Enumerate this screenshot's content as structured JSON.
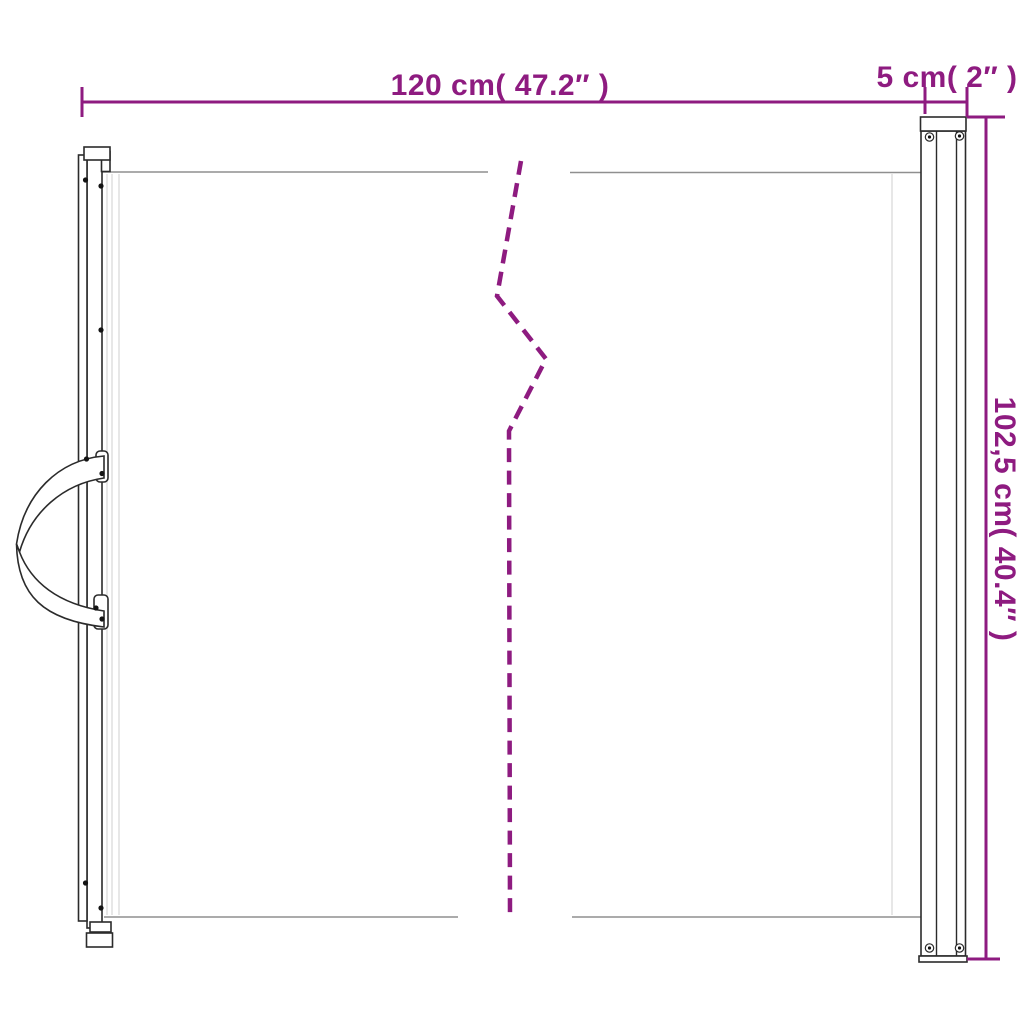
{
  "page": {
    "background": "#ffffff"
  },
  "diagram": {
    "accent_color": "#8e1b80",
    "outline_color": "#2b2b2b",
    "mesh_line_color": "#8f8f8f",
    "labels": {
      "width": "120 cm( 47.2″ )",
      "post_width": "5 cm( 2″ )",
      "height": "102,5 cm( 40.4″ )"
    }
  }
}
